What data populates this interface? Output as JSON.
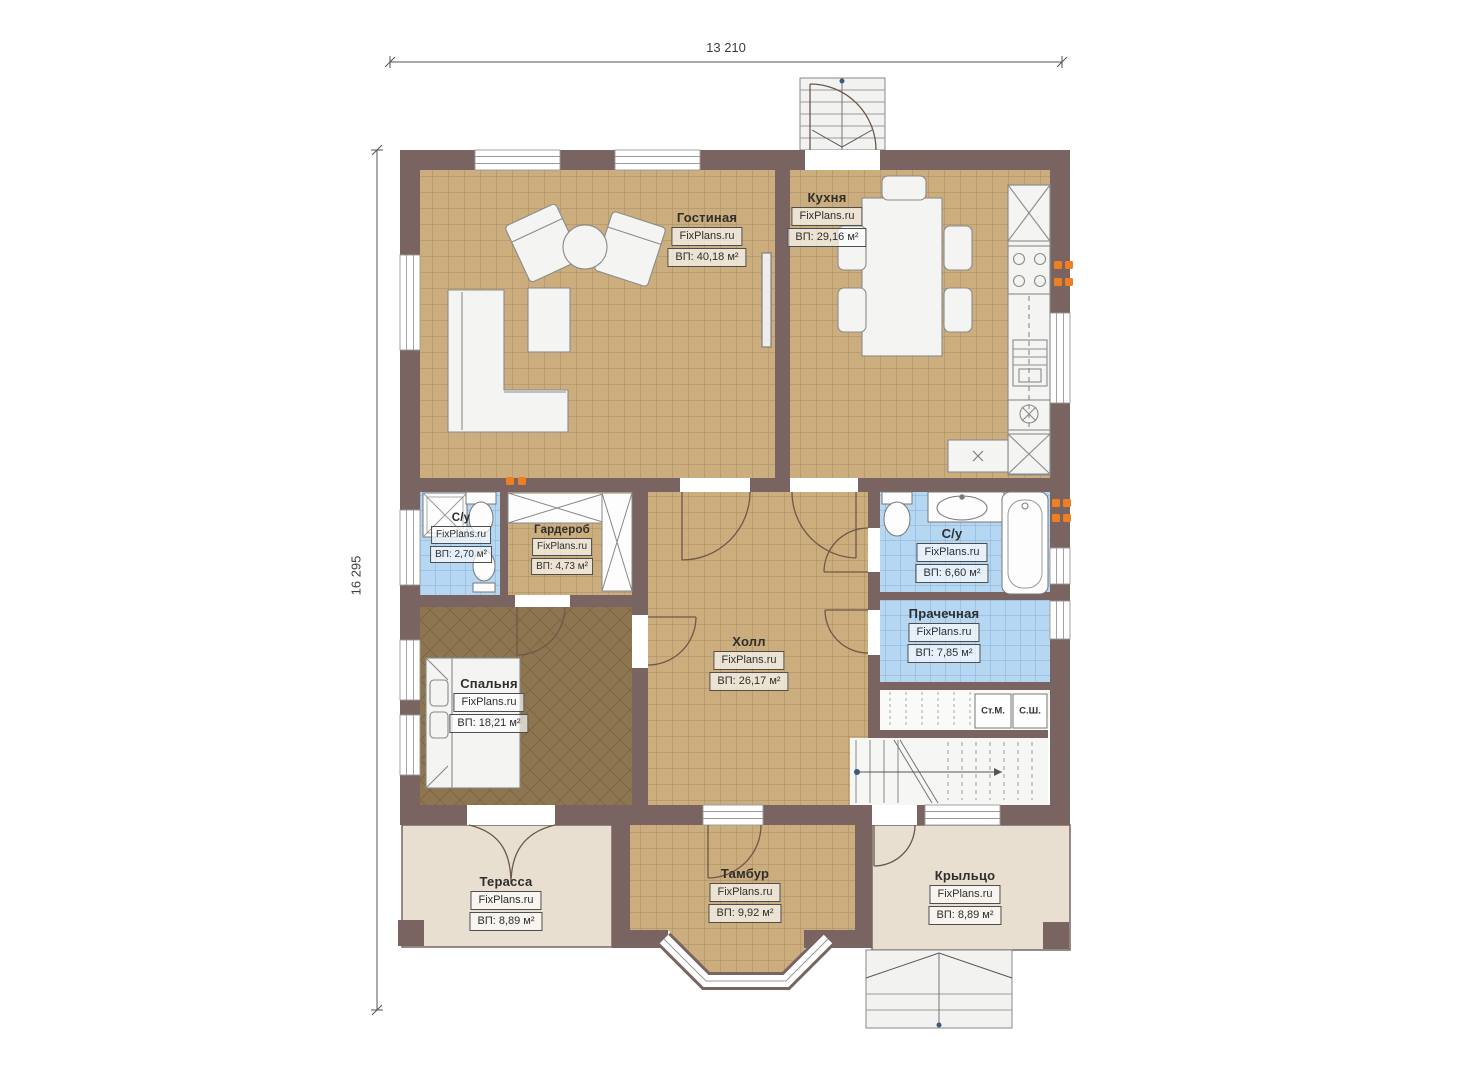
{
  "plan": {
    "watermark": "FixPlans.ru",
    "dimensions": {
      "width_label": "13 210",
      "height_label": "16 295"
    },
    "rooms": [
      {
        "name": "Гостиная",
        "area": "ВП: 40,18 м²"
      },
      {
        "name": "Кухня",
        "area": "ВП: 29,16 м²"
      },
      {
        "name": "С/у",
        "area": "ВП: 2,70 м²"
      },
      {
        "name": "Гардероб",
        "area": "ВП: 4,73 м²"
      },
      {
        "name": "С/у",
        "area": "ВП: 6,60 м²"
      },
      {
        "name": "Прачечная",
        "area": "ВП: 7,85 м²"
      },
      {
        "name": "Холл",
        "area": "ВП: 26,17 м²"
      },
      {
        "name": "Спальня",
        "area": "ВП: 18,21 м²"
      },
      {
        "name": "Терасса",
        "area": "ВП: 8,89 м²"
      },
      {
        "name": "Тамбур",
        "area": "ВП: 9,92 м²"
      },
      {
        "name": "Крыльцо",
        "area": "ВП: 8,89 м²"
      }
    ],
    "appliances": {
      "washing_machine": "Ст.М.",
      "drying_cabinet": "С.Ш."
    },
    "colors": {
      "wall": "#796462",
      "floor_tile_tan": "#cbad7e",
      "floor_tile_blue": "#b6d7f2",
      "floor_wood_brown": "#8d7550",
      "outdoor_beige": "#e9dfd0",
      "outlet_orange": "#ef7f23"
    }
  }
}
